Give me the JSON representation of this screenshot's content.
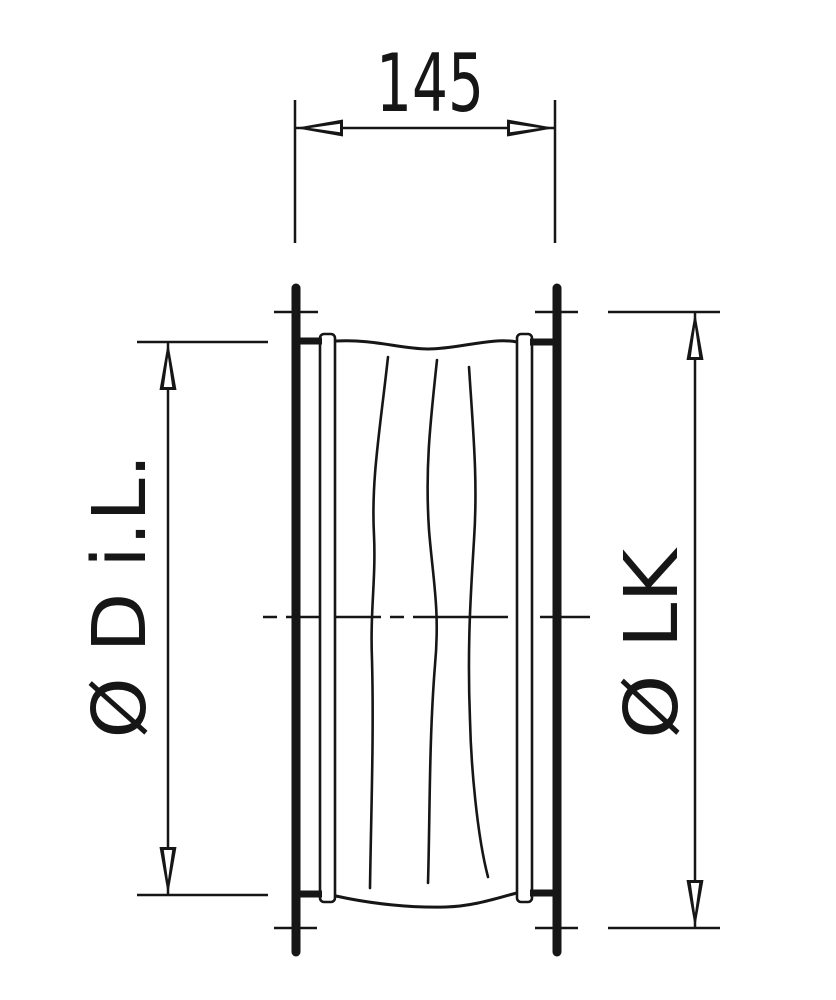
{
  "drawing": {
    "dimension_width": {
      "value": "145"
    },
    "dimension_inner_diameter": {
      "label": "Ø D i.L."
    },
    "dimension_bolt_circle": {
      "label": "Ø LK"
    }
  },
  "colors": {
    "ink": "#161616",
    "background": "#ffffff"
  }
}
